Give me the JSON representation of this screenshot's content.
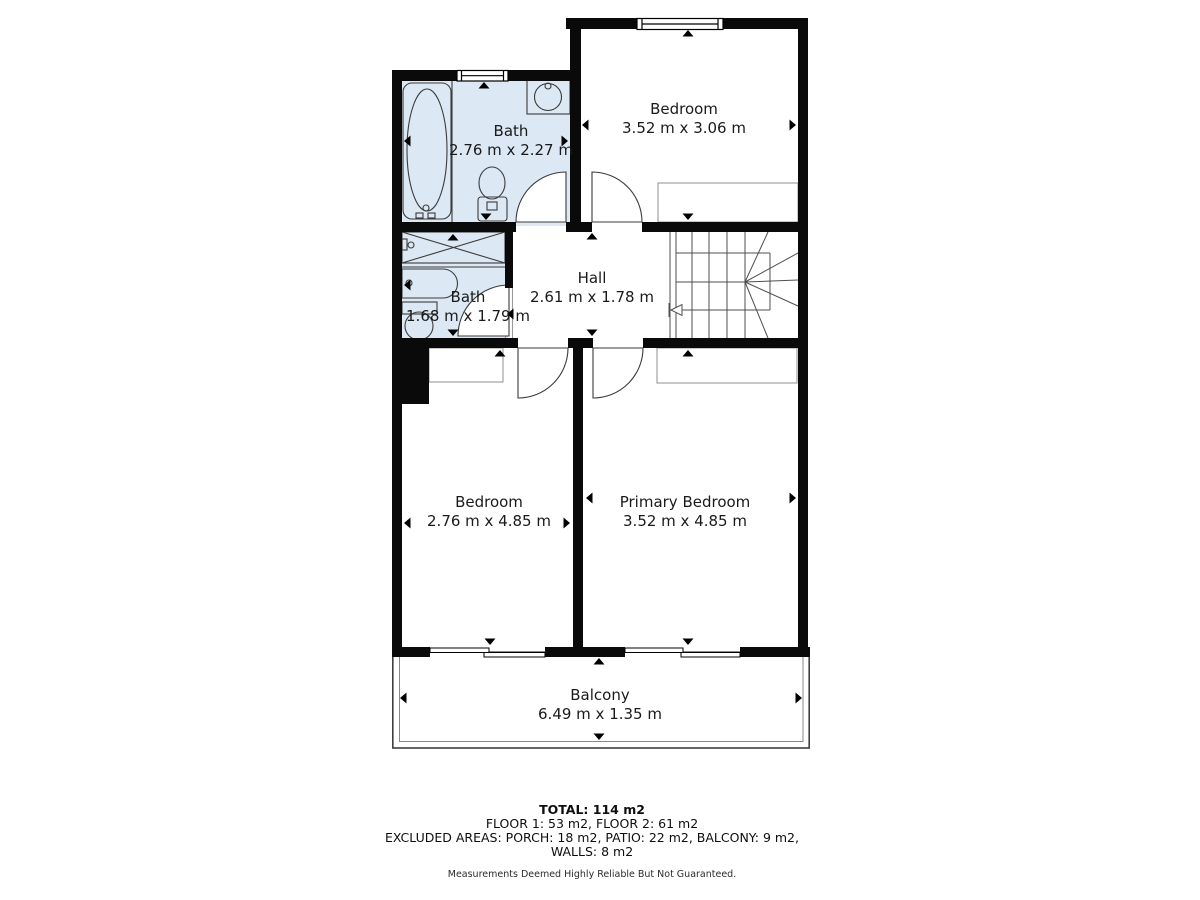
{
  "plan": {
    "rooms": {
      "bath_upper": {
        "name": "Bath",
        "dimensions": "2.76 m x 2.27 m"
      },
      "bedroom_upper": {
        "name": "Bedroom",
        "dimensions": "3.52 m x 3.06 m"
      },
      "bath_lower": {
        "name": "Bath",
        "dimensions": "1.68 m x 1.79 m"
      },
      "hall": {
        "name": "Hall",
        "dimensions": "2.61 m x 1.78 m"
      },
      "bedroom_lower": {
        "name": "Bedroom",
        "dimensions": "2.76 m x 4.85 m"
      },
      "primary_bedroom": {
        "name": "Primary Bedroom",
        "dimensions": "3.52 m x 4.85 m"
      },
      "balcony": {
        "name": "Balcony",
        "dimensions": "6.49 m x 1.35 m"
      }
    },
    "fixtures": [
      "bathtub-icon",
      "sink-icon",
      "toilet-icon",
      "shower-icon",
      "staircase-icon",
      "window-icon",
      "sliding-door-icon",
      "door-swing-icon",
      "closet"
    ],
    "colors": {
      "wall": "#0a0a0a",
      "wet_room_fill": "#dce8f4",
      "fixture_line": "#3b3b3b"
    }
  },
  "summary": {
    "total": "TOTAL: 114 m2",
    "floors": "FLOOR 1: 53 m2, FLOOR 2: 61 m2",
    "excluded": "EXCLUDED AREAS: PORCH: 18 m2, PATIO: 22 m2, BALCONY: 9 m2,",
    "walls": "WALLS: 8 m2",
    "disclaimer": "Measurements Deemed Highly Reliable But Not Guaranteed."
  }
}
